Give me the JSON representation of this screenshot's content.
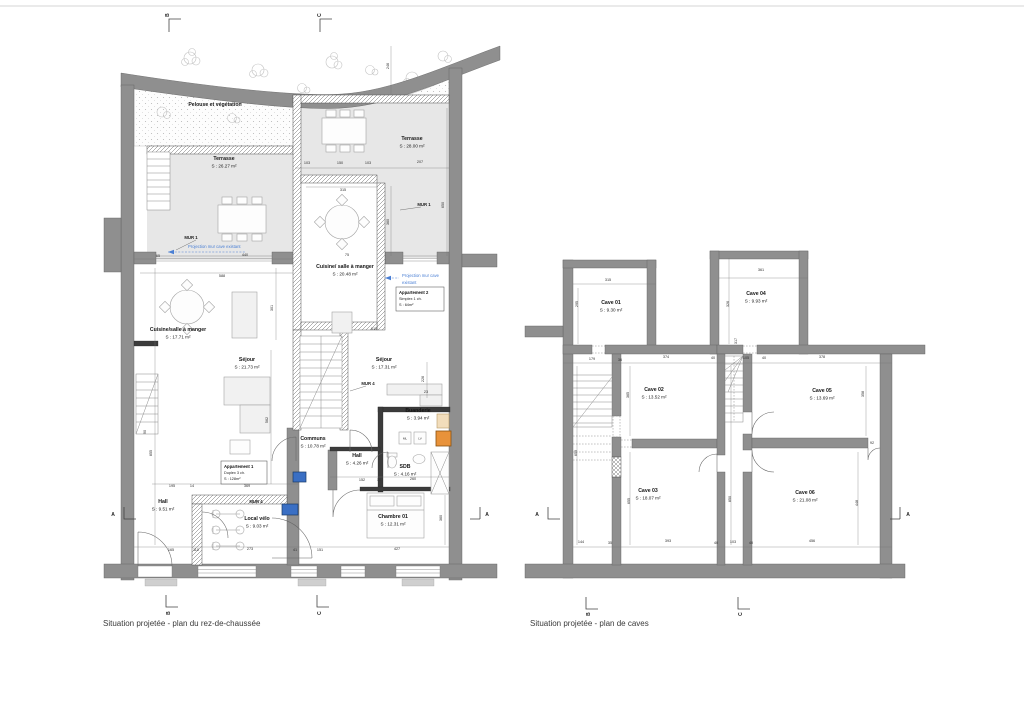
{
  "sheet": {
    "captions": {
      "ground": "Situation projetée - plan du rez-de-chaussée",
      "caves": "Situation projetée - plan de caves"
    }
  },
  "colors": {
    "wall_gray": "#8f8f8f",
    "terrace_gray": "#e7e7e7",
    "annotation_blue": "#4a7fd4",
    "boiler_orange": "#e8923a",
    "tan": "#f2ddbb",
    "electric_blue": "#3a6fc4"
  },
  "ground_floor": {
    "rooms": [
      {
        "name": "Pelouse et végétation",
        "area": "",
        "x": 215,
        "y": 106
      },
      {
        "name": "Terrasse",
        "area": "S : 26.27 m²",
        "x": 224,
        "y": 160
      },
      {
        "name": "Terrasse",
        "area": "S : 28.00 m²",
        "x": 412,
        "y": 140
      },
      {
        "name": "Cuisine/ salle à manger",
        "area": "S : 20.48 m²",
        "x": 345,
        "y": 268
      },
      {
        "name": "Cuisine/salle à manger",
        "area": "S : 17.71 m²",
        "x": 178,
        "y": 331
      },
      {
        "name": "Séjour",
        "area": "S : 21.73 m²",
        "x": 247,
        "y": 361
      },
      {
        "name": "Séjour",
        "area": "S : 17.31 m²",
        "x": 384,
        "y": 361
      },
      {
        "name": "Buanderie",
        "area": "S : 3.94 m²",
        "x": 418,
        "y": 412
      },
      {
        "name": "Communs",
        "area": "S : 10.78 m²",
        "x": 313,
        "y": 440
      },
      {
        "name": "Hall",
        "area": "S : 4.26 m²",
        "x": 357,
        "y": 457
      },
      {
        "name": "SDB",
        "area": "S : 4.16 m²",
        "x": 405,
        "y": 468
      },
      {
        "name": "Hall",
        "area": "S : 9.51 m²",
        "x": 163,
        "y": 503
      },
      {
        "name": "Local vélo",
        "area": "S : 9.03 m²",
        "x": 257,
        "y": 520
      },
      {
        "name": "Chambre 01",
        "area": "S : 12.31 m²",
        "x": 393,
        "y": 518
      }
    ],
    "apartments": [
      {
        "l1": "Appartement 1",
        "l2": "Duplex 3 ch.",
        "l3": "S : 128m²",
        "x": 221,
        "y": 461,
        "w": 46,
        "h": 23
      },
      {
        "l1": "Appartement 2",
        "l2": "Simplex 1 ch.",
        "l3": "S : 64m²",
        "x": 396,
        "y": 287,
        "w": 48,
        "h": 24
      }
    ],
    "wall_labels": [
      {
        "t": "MUR 1",
        "x": 191,
        "y": 239
      },
      {
        "t": "MUR 1",
        "x": 424,
        "y": 206
      },
      {
        "t": "MUR 4",
        "x": 368,
        "y": 385
      },
      {
        "t": "MUR 4",
        "x": 256,
        "y": 503
      }
    ],
    "annotations": [
      {
        "t": "Projection mur cave existant",
        "x": 188,
        "y": 248
      },
      {
        "t": "Projection mur cave",
        "x": 402,
        "y": 277
      },
      {
        "t": "existant",
        "x": 402,
        "y": 284
      }
    ],
    "appliances": {
      "ml": "ML",
      "lv": "LV"
    },
    "dims": [
      {
        "t": "65",
        "x": 158,
        "y": 257
      },
      {
        "t": "440",
        "x": 245,
        "y": 256
      },
      {
        "t": "75",
        "x": 347,
        "y": 256
      },
      {
        "t": "588",
        "x": 222,
        "y": 277
      },
      {
        "t": "103",
        "x": 307,
        "y": 164
      },
      {
        "t": "150",
        "x": 340,
        "y": 164
      },
      {
        "t": "103",
        "x": 368,
        "y": 164
      },
      {
        "t": "207",
        "x": 420,
        "y": 163
      },
      {
        "t": "315",
        "x": 343,
        "y": 191
      },
      {
        "t": "246",
        "x": 389,
        "y": 66,
        "r": 1
      },
      {
        "t": "650",
        "x": 444,
        "y": 205,
        "r": 1
      },
      {
        "t": "360",
        "x": 389,
        "y": 222,
        "r": 1
      },
      {
        "t": "301",
        "x": 273,
        "y": 308,
        "r": 1
      },
      {
        "t": "613",
        "x": 374,
        "y": 330
      },
      {
        "t": "562",
        "x": 268,
        "y": 420,
        "r": 1
      },
      {
        "t": "855",
        "x": 152,
        "y": 453,
        "r": 1
      },
      {
        "t": "226",
        "x": 424,
        "y": 379,
        "r": 1
      },
      {
        "t": "23",
        "x": 426,
        "y": 393
      },
      {
        "t": "195",
        "x": 172,
        "y": 487
      },
      {
        "t": "14",
        "x": 192,
        "y": 487
      },
      {
        "t": "369",
        "x": 247,
        "y": 487
      },
      {
        "t": "152",
        "x": 362,
        "y": 481
      },
      {
        "t": "10",
        "x": 379,
        "y": 481
      },
      {
        "t": "260",
        "x": 413,
        "y": 480
      },
      {
        "t": "165",
        "x": 171,
        "y": 551
      },
      {
        "t": "110",
        "x": 196,
        "y": 551
      },
      {
        "t": "273",
        "x": 250,
        "y": 550
      },
      {
        "t": "41",
        "x": 295,
        "y": 551
      },
      {
        "t": "151",
        "x": 320,
        "y": 551
      },
      {
        "t": "427",
        "x": 397,
        "y": 550
      },
      {
        "t": "360",
        "x": 442,
        "y": 518,
        "r": 1
      },
      {
        "t": "90",
        "x": 146,
        "y": 432,
        "r": 1
      }
    ],
    "sections": [
      {
        "t": "B",
        "x": 169,
        "y": 15,
        "r": 1
      },
      {
        "t": "C",
        "x": 321,
        "y": 15,
        "r": 1
      },
      {
        "t": "A",
        "x": 113,
        "y": 516
      },
      {
        "t": "A",
        "x": 487,
        "y": 516
      },
      {
        "t": "B",
        "x": 170,
        "y": 613,
        "r": 1
      },
      {
        "t": "C",
        "x": 321,
        "y": 613,
        "r": 1
      }
    ]
  },
  "caves": {
    "rooms": [
      {
        "name": "Cave 01",
        "area": "S : 9.30 m²",
        "x": 611,
        "y": 304
      },
      {
        "name": "Cave 04",
        "area": "S : 9.93 m²",
        "x": 756,
        "y": 295
      },
      {
        "name": "Cave 02",
        "area": "S : 13.52 m²",
        "x": 654,
        "y": 391
      },
      {
        "name": "Cave 05",
        "area": "S : 13.69 m²",
        "x": 822,
        "y": 392
      },
      {
        "name": "Cave 03",
        "area": "S : 18.07 m²",
        "x": 648,
        "y": 492
      },
      {
        "name": "Cave 06",
        "area": "S : 21.08 m²",
        "x": 805,
        "y": 494
      }
    ],
    "dims": [
      {
        "t": "315",
        "x": 608,
        "y": 281
      },
      {
        "t": "295",
        "x": 578,
        "y": 304,
        "r": 1
      },
      {
        "t": "361",
        "x": 761,
        "y": 271
      },
      {
        "t": "326",
        "x": 729,
        "y": 304,
        "r": 1
      },
      {
        "t": "179",
        "x": 592,
        "y": 360
      },
      {
        "t": "36",
        "x": 620,
        "y": 361
      },
      {
        "t": "374",
        "x": 666,
        "y": 358
      },
      {
        "t": "40",
        "x": 713,
        "y": 359
      },
      {
        "t": "105",
        "x": 746,
        "y": 359
      },
      {
        "t": "40",
        "x": 764,
        "y": 359
      },
      {
        "t": "378",
        "x": 822,
        "y": 358
      },
      {
        "t": "317",
        "x": 737,
        "y": 341,
        "r": 1
      },
      {
        "t": "365",
        "x": 629,
        "y": 395,
        "r": 1
      },
      {
        "t": "358",
        "x": 864,
        "y": 394,
        "r": 1
      },
      {
        "t": "659",
        "x": 577,
        "y": 453,
        "r": 1
      },
      {
        "t": "850",
        "x": 731,
        "y": 499,
        "r": 1
      },
      {
        "t": "655",
        "x": 630,
        "y": 501,
        "r": 1
      },
      {
        "t": "448",
        "x": 858,
        "y": 503,
        "r": 1
      },
      {
        "t": "92",
        "x": 872,
        "y": 444
      },
      {
        "t": "144",
        "x": 581,
        "y": 543
      },
      {
        "t": "35",
        "x": 610,
        "y": 544
      },
      {
        "t": "393",
        "x": 668,
        "y": 542
      },
      {
        "t": "40",
        "x": 716,
        "y": 544
      },
      {
        "t": "103",
        "x": 733,
        "y": 543
      },
      {
        "t": "40",
        "x": 751,
        "y": 544
      },
      {
        "t": "456",
        "x": 812,
        "y": 542
      }
    ],
    "sections": [
      {
        "t": "A",
        "x": 537,
        "y": 516
      },
      {
        "t": "A",
        "x": 908,
        "y": 516
      },
      {
        "t": "B",
        "x": 590,
        "y": 614,
        "r": 1
      },
      {
        "t": "C",
        "x": 742,
        "y": 614,
        "r": 1
      }
    ]
  }
}
